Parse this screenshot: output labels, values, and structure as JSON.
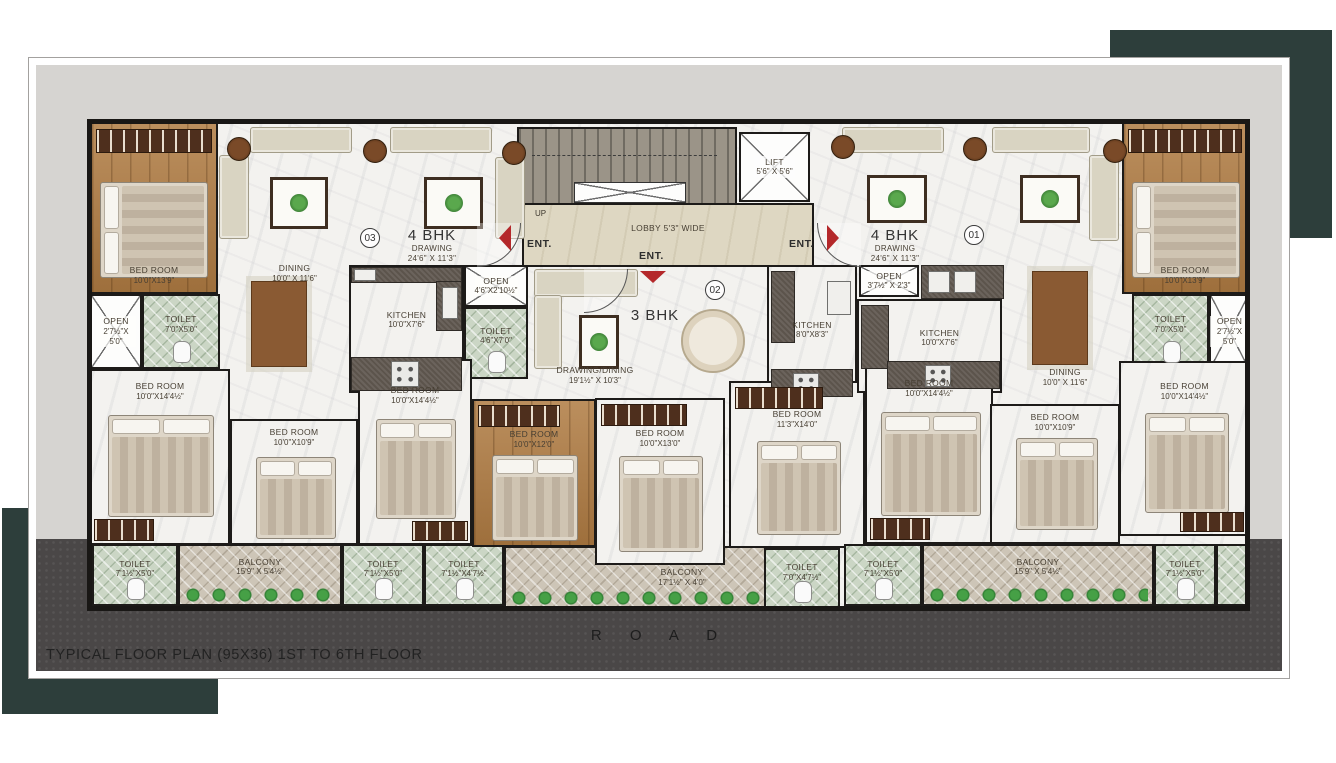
{
  "title": "TYPICAL FLOOR PLAN (95X36) 1ST TO 6TH FLOOR",
  "road": "R O A D",
  "core": {
    "lift": {
      "name": "LIFT",
      "dims": "5'6\" X 5'6\""
    },
    "lobby": "LOBBY 5'3\" WIDE",
    "up": "UP",
    "ent_left": "ENT.",
    "ent_center": "ENT.",
    "ent_right": "ENT."
  },
  "unit03": {
    "number": "03",
    "type": "4 BHK",
    "drawing": "DRAWING",
    "drawing_dims": "24'6\" X 11'3\"",
    "bedroom_top": {
      "name": "BED ROOM",
      "dims": "10'0\"X13'9\""
    },
    "open_left": {
      "name": "OPEN",
      "dims": "2'7½\"X 5'0\""
    },
    "toilet_left": {
      "name": "TOILET",
      "dims": "7'0\"X5'0\""
    },
    "dining": {
      "name": "DINING",
      "dims": "10'0\" X 11'6\""
    },
    "kitchen": {
      "name": "KITCHEN",
      "dims": "10'0\"X7'6\""
    },
    "open_mid": {
      "name": "OPEN",
      "dims": "4'6\"X2'10½\""
    },
    "toilet_mid": {
      "name": "TOILET",
      "dims": "4'6\"X7'0\""
    },
    "bedroom_left": {
      "name": "BED ROOM",
      "dims": "10'0\"X14'4½\""
    },
    "bedroom_mid": {
      "name": "BED ROOM",
      "dims": "10'0\"X10'9\""
    },
    "bedroom_center": {
      "name": "BED ROOM",
      "dims": "10'0\"X14'4½\""
    },
    "toilet_b1": {
      "name": "TOILET",
      "dims": "7'1½\"X5'0\""
    },
    "balcony": {
      "name": "BALCONY",
      "dims": "15'9\" X 5'4½\""
    },
    "toilet_b2": {
      "name": "TOILET",
      "dims": "7'1½\"X5'0\""
    }
  },
  "unit02": {
    "number": "02",
    "type": "3 BHK",
    "drawing_dining": {
      "name": "DRAWING/DINING",
      "dims": "19'1½\" X 10'3\""
    },
    "kitchen": {
      "name": "KITCHEN",
      "dims": "8'0\"X8'3\""
    },
    "open": {
      "name": "OPEN",
      "dims": "3'7½\" X 2'3\""
    },
    "bedroom_left": {
      "name": "BED ROOM",
      "dims": "10'0\"X12'0\""
    },
    "bedroom_mid": {
      "name": "BED ROOM",
      "dims": "10'0\"X13'0\""
    },
    "bedroom_right": {
      "name": "BED ROOM",
      "dims": "11'3\"X14'0\""
    },
    "toilet_left": {
      "name": "TOILET",
      "dims": "7'1½\"X4'7½\""
    },
    "balcony": {
      "name": "BALCONY",
      "dims": "17'1½\" X 4'0\""
    },
    "toilet_right": {
      "name": "TOILET",
      "dims": "7'0\"X4'7½\""
    }
  },
  "unit01": {
    "number": "01",
    "type": "4 BHK",
    "drawing": "DRAWING",
    "drawing_dims": "24'6\" X 11'3\"",
    "bedroom_top": {
      "name": "BED ROOM",
      "dims": "10'0\"X13'9\""
    },
    "kitchen": {
      "name": "KITCHEN",
      "dims": "10'0\"X7'6\""
    },
    "dining": {
      "name": "DINING",
      "dims": "10'0\" X 11'6\""
    },
    "toilet_top": {
      "name": "TOILET",
      "dims": "7'0\"X5'0\""
    },
    "open_right": {
      "name": "OPEN",
      "dims": "2'7½\"X 5'0\""
    },
    "bedroom_left": {
      "name": "BED ROOM",
      "dims": "10'0\"X14'4½\""
    },
    "bedroom_mid": {
      "name": "BED ROOM",
      "dims": "10'0\"X10'9\""
    },
    "bedroom_right": {
      "name": "BED ROOM",
      "dims": "10'0\"X14'4½\""
    },
    "toilet_b1": {
      "name": "TOILET",
      "dims": "7'1½\"X5'0\""
    },
    "balcony": {
      "name": "BALCONY",
      "dims": "15'9\" X 5'4½\""
    },
    "toilet_b2": {
      "name": "TOILET",
      "dims": "7'1½\"X5'0\""
    }
  }
}
